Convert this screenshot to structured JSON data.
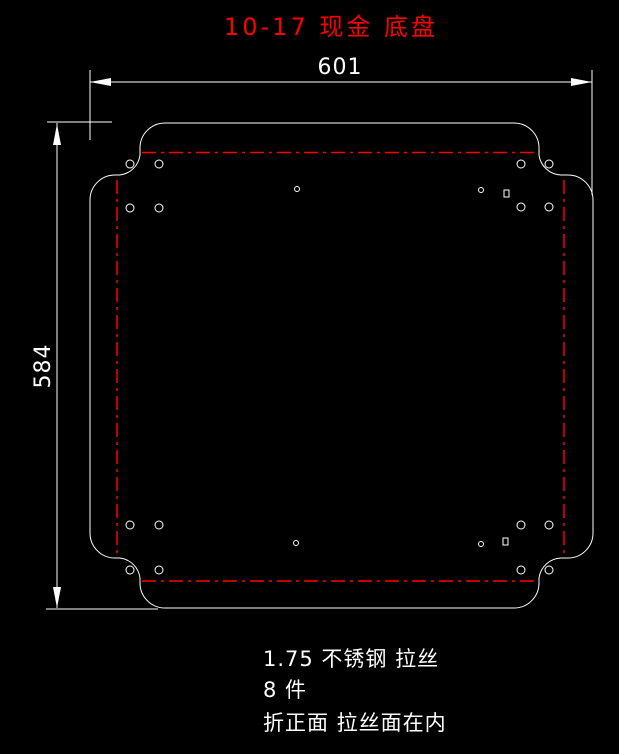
{
  "title": {
    "text": "10-17 现金 底盘",
    "color": "#ff0000"
  },
  "dimensions": {
    "width_label": "601",
    "height_label": "584"
  },
  "notes": {
    "material": "1.75 不锈钢 拉丝",
    "quantity": "8 件",
    "instruction": "折正面 拉丝面在内"
  },
  "colors": {
    "background": "#000000",
    "geometry": "#ffffff",
    "bend_line": "#ff0000",
    "title": "#ff0000"
  },
  "drawing": {
    "part_type": "sheet-metal flat pattern with four folded flanges",
    "bend_line_style": "dash-dot",
    "hole_radius": 4,
    "corner_holes": [
      [
        130,
        164
      ],
      [
        159,
        164
      ],
      [
        130,
        208
      ],
      [
        159,
        208
      ],
      [
        521,
        164
      ],
      [
        549,
        164
      ],
      [
        521,
        207
      ],
      [
        549,
        207
      ],
      [
        130,
        525
      ],
      [
        159,
        525
      ],
      [
        130,
        570
      ],
      [
        159,
        570
      ],
      [
        521,
        525
      ],
      [
        549,
        525
      ],
      [
        521,
        570
      ],
      [
        549,
        570
      ]
    ],
    "small_hole_radius": 2.5,
    "small_holes": [
      [
        297,
        189
      ],
      [
        481,
        190
      ],
      [
        296,
        543
      ],
      [
        481,
        544
      ]
    ],
    "rect_slot_size": [
      5,
      7
    ],
    "rect_slots": [
      [
        504,
        190
      ],
      [
        503,
        538
      ]
    ]
  }
}
